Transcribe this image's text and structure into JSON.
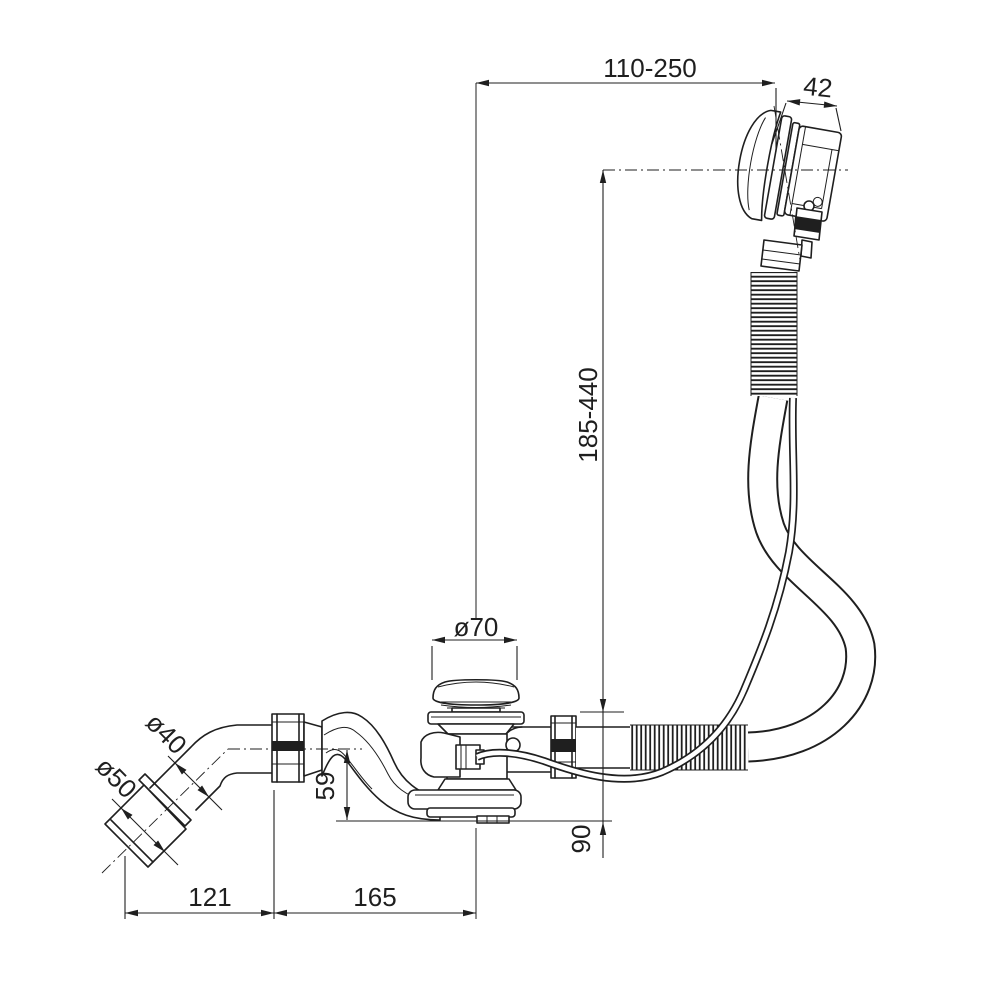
{
  "drawing": {
    "type": "technical-drawing",
    "subject": "bath-waste-overflow-kit-side-view",
    "background_color": "#ffffff",
    "line_color": "#1f1f1f",
    "dimensions": {
      "overflow_reach": "110-250",
      "overflow_head_depth": "42",
      "overflow_hose_length": "185-440",
      "plug_cap_diameter": "ø70",
      "outlet_pipe_diameter": "ø40",
      "outlet_socket_diameter": "ø50",
      "outlet_axis_to_base": "59",
      "waste_body_drop": "90",
      "socket_length": "121",
      "outlet_to_drain_center": "165"
    }
  }
}
